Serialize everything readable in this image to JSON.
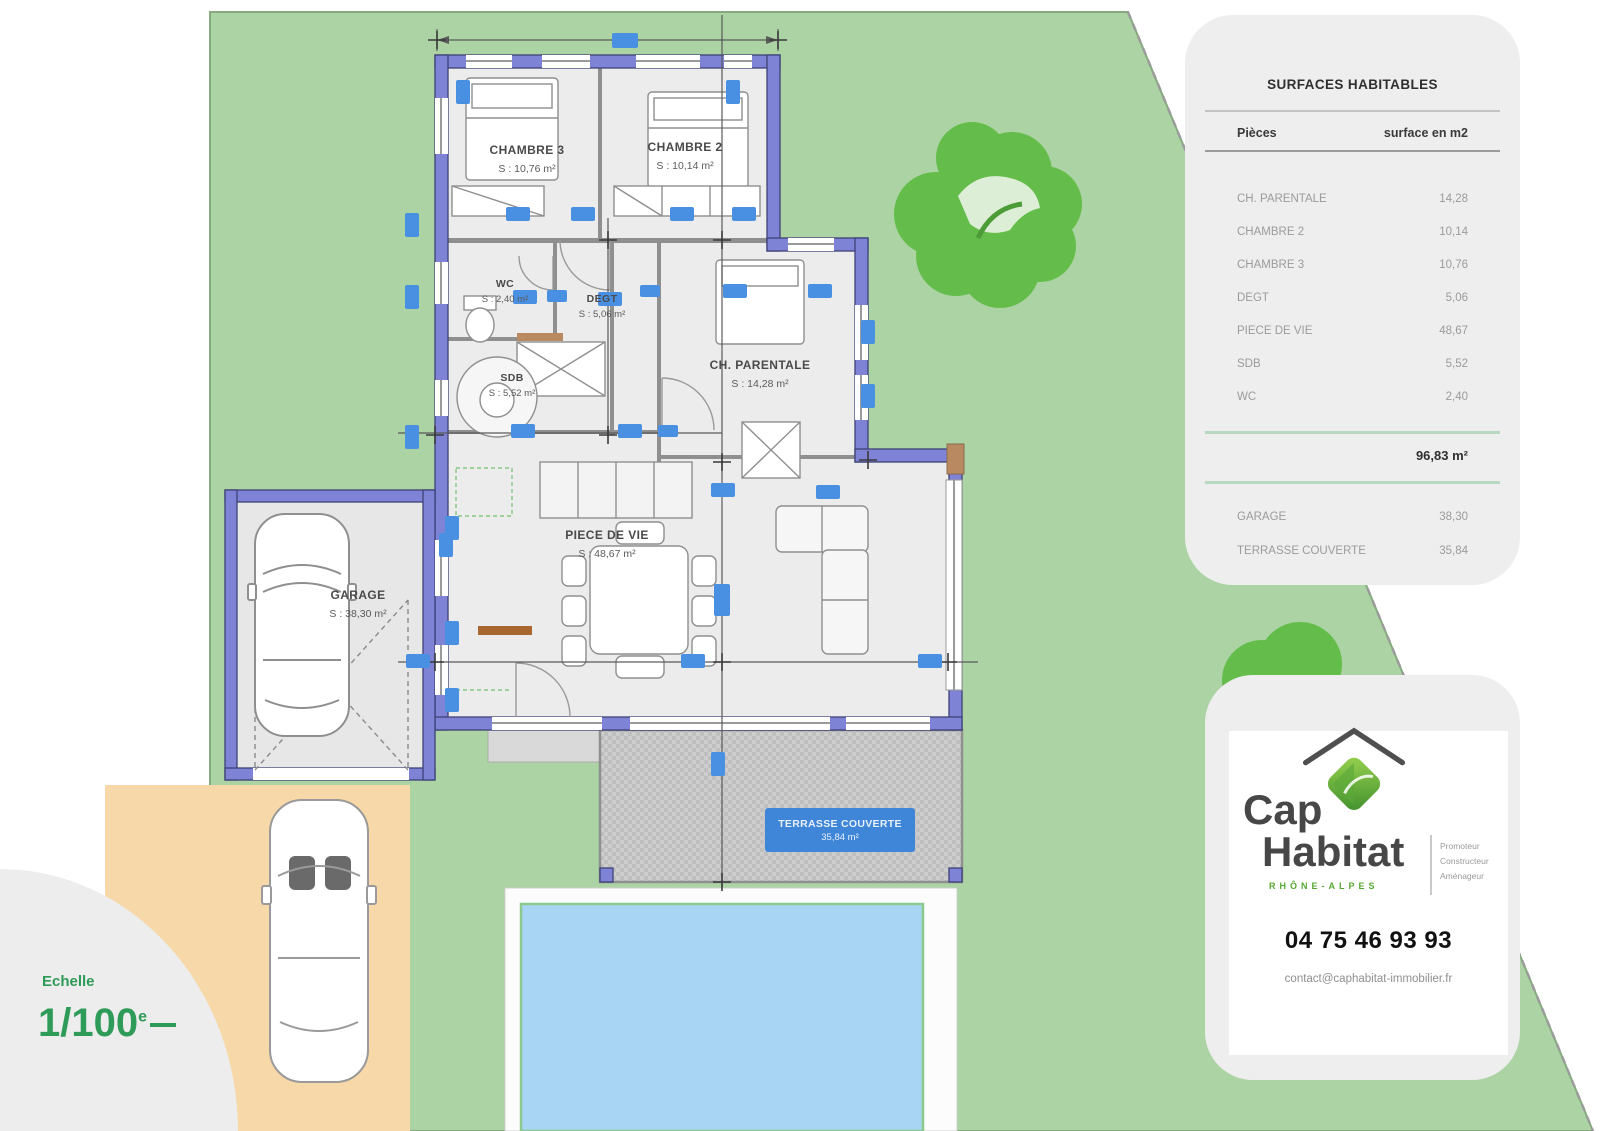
{
  "scale": {
    "label": "Echelle",
    "value": "1/100",
    "suffix": "e"
  },
  "surfaces_table": {
    "title": "SURFACES HABITABLES",
    "columns": {
      "rooms": "Pièces",
      "area": "surface en m2"
    },
    "rows": [
      {
        "label": "CH. PARENTALE",
        "value": "14,28"
      },
      {
        "label": "CHAMBRE 2",
        "value": "10,14"
      },
      {
        "label": "CHAMBRE 3",
        "value": "10,76"
      },
      {
        "label": "DEGT",
        "value": "5,06"
      },
      {
        "label": "PIECE DE VIE",
        "value": "48,67"
      },
      {
        "label": "SDB",
        "value": "5,52"
      },
      {
        "label": "WC",
        "value": "2,40"
      }
    ],
    "total": "96,83 m²",
    "annex_rows": [
      {
        "label": "GARAGE",
        "value": "38,30"
      },
      {
        "label": "TERRASSE COUVERTE",
        "value": "35,84"
      }
    ]
  },
  "rooms": [
    {
      "id": "chambre3",
      "name": "CHAMBRE 3",
      "area": "S : 10,76 m²"
    },
    {
      "id": "chambre2",
      "name": "CHAMBRE 2",
      "area": "S : 10,14 m²"
    },
    {
      "id": "wc",
      "name": "WC",
      "area": "S : 2,40 m²"
    },
    {
      "id": "degt",
      "name": "DEGT",
      "area": "S : 5,06 m²"
    },
    {
      "id": "sdb",
      "name": "SDB",
      "area": "S : 5,52 m²"
    },
    {
      "id": "parentale",
      "name": "CH. PARENTALE",
      "area": "S : 14,28 m²"
    },
    {
      "id": "piece_de_vie",
      "name": "PIECE DE VIE",
      "area": "S : 48,67 m²"
    },
    {
      "id": "garage",
      "name": "GARAGE",
      "area": "S : 38,30 m²"
    }
  ],
  "terrace_label": {
    "line1": "TERRASSE COUVERTE",
    "line2": "35,84 m²"
  },
  "brand": {
    "name_top": "Cap",
    "name_bottom": "Habitat",
    "region": "RHÔNE-ALPES",
    "taglines": [
      "Promoteur",
      "Constructeur",
      "Aménageur"
    ],
    "phone": "04 75 46 93 93",
    "email": "contact@caphabitat-immobilier.fr"
  },
  "colors": {
    "lawn": "#abd3a3",
    "tree": "#64bd4a",
    "wall": "#7e83d6",
    "wall_outline": "#3f4276",
    "marker_blue": "#4a90e2",
    "pool": "#a9d5f4",
    "driveway": "#f7d8a9",
    "accent_green": "#2e9b58",
    "terrace_label_bg": "#3f86d8"
  }
}
